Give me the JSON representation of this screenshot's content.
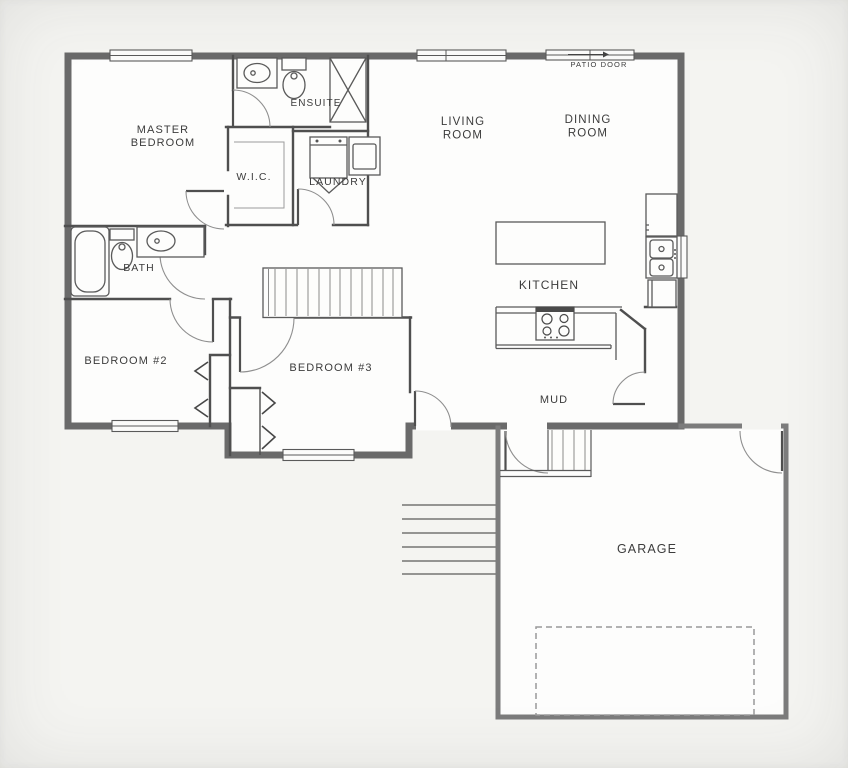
{
  "plan": {
    "title": "Main floor plan with attached garage",
    "colors": {
      "bg": "#f4f4f1",
      "floor": "#fdfdfc",
      "wall_ext": "#6a6a6a",
      "wall_gar": "#7c7c7c",
      "wall_int": "#4f4f4f",
      "fixture": "#5a5a5a",
      "arc": "#8f8f8f",
      "stair": "#8a8a8a",
      "dash": "#9a9a9a",
      "label": "#3c3c3c"
    },
    "labels": [
      {
        "id": "master-bedroom",
        "lines": [
          "MASTER",
          "BEDROOM"
        ],
        "x": 163,
        "y": 133,
        "size": 11,
        "lh": 13
      },
      {
        "id": "ensuite",
        "lines": [
          "ENSUITE"
        ],
        "x": 316,
        "y": 106,
        "size": 10,
        "lh": 12
      },
      {
        "id": "wic",
        "lines": [
          "W.I.C."
        ],
        "x": 254,
        "y": 180,
        "size": 10.5,
        "lh": 12
      },
      {
        "id": "laundry",
        "lines": [
          "LAUNDRY"
        ],
        "x": 338,
        "y": 185,
        "size": 10.5,
        "lh": 12
      },
      {
        "id": "living-room",
        "lines": [
          "LIVING",
          "ROOM"
        ],
        "x": 463,
        "y": 125,
        "size": 11.5,
        "lh": 13.5
      },
      {
        "id": "dining-room",
        "lines": [
          "DINING",
          "ROOM"
        ],
        "x": 588,
        "y": 123,
        "size": 11.5,
        "lh": 13.5
      },
      {
        "id": "patio-door",
        "lines": [
          "PATIO DOOR"
        ],
        "x": 599,
        "y": 67,
        "size": 7.5,
        "lh": 9
      },
      {
        "id": "bath",
        "lines": [
          "BATH"
        ],
        "x": 139,
        "y": 271,
        "size": 10.5,
        "lh": 12
      },
      {
        "id": "bedroom-2",
        "lines": [
          "BEDROOM #2"
        ],
        "x": 126,
        "y": 364,
        "size": 11,
        "lh": 13
      },
      {
        "id": "bedroom-3",
        "lines": [
          "BEDROOM #3"
        ],
        "x": 331,
        "y": 371,
        "size": 11,
        "lh": 13
      },
      {
        "id": "kitchen",
        "lines": [
          "KITCHEN"
        ],
        "x": 549,
        "y": 289,
        "size": 12,
        "lh": 14
      },
      {
        "id": "mud",
        "lines": [
          "MUD"
        ],
        "x": 554,
        "y": 403,
        "size": 11,
        "lh": 13
      },
      {
        "id": "garage",
        "lines": [
          "GARAGE"
        ],
        "x": 647,
        "y": 553,
        "size": 12.5,
        "lh": 14
      }
    ],
    "rooms": [
      "Master Bedroom",
      "Ensuite",
      "W.I.C.",
      "Laundry",
      "Living Room",
      "Dining Room",
      "Bath",
      "Bedroom #2",
      "Bedroom #3",
      "Kitchen",
      "Mud",
      "Garage"
    ],
    "fixtures": [
      "bathtub",
      "toilet",
      "vanity-sink",
      "shower",
      "washer",
      "dryer",
      "kitchen-island",
      "range-stove",
      "refrigerator",
      "double-sink",
      "base-cabinet",
      "corner-pantry",
      "stairs-main",
      "stairs-basement",
      "stairs-exterior",
      "garage-overhead-door"
    ],
    "windows": [
      "master-bedroom-window",
      "living-room-window",
      "patio-door",
      "bedroom-2-window",
      "bedroom-3-window",
      "kitchen-sink-window"
    ],
    "doors": [
      "ensuite-door",
      "master-bedroom-door",
      "bath-door",
      "laundry-door",
      "bedroom-2-door",
      "bedroom-3-door",
      "side-entry-door",
      "pantry-door",
      "garage-landing-door",
      "garage-service-door"
    ]
  }
}
